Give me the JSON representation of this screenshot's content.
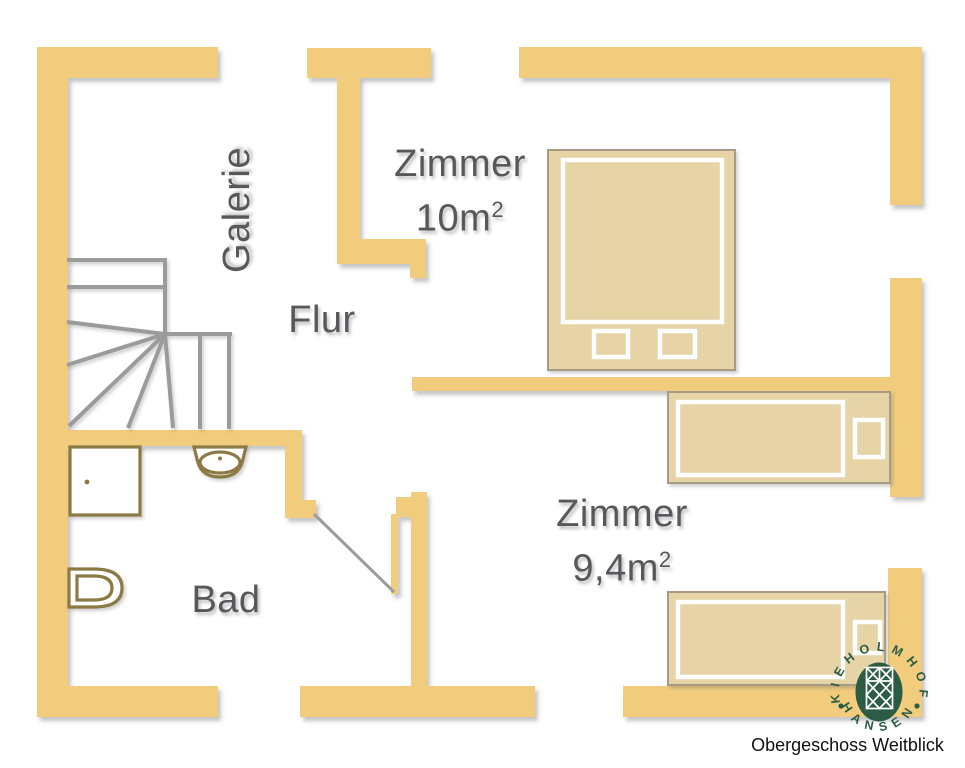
{
  "plan": {
    "colors": {
      "wall": "#F0CC7C",
      "stairs": "#9B9B9B",
      "fixture": "#8C7A45",
      "bed_fill": "#E6D3A6",
      "bed_border": "#A79B85",
      "label": "#58585A",
      "logo_green": "#2D5C45",
      "caption": "#111111"
    },
    "rooms": {
      "galerie": {
        "label": "Galerie"
      },
      "zimmer_10": {
        "label": "Zimmer",
        "area": "10m",
        "area_sup": "2"
      },
      "flur": {
        "label": "Flur"
      },
      "zimmer_9_4": {
        "label": "Zimmer",
        "area": "9,4m",
        "area_sup": "2"
      },
      "bad": {
        "label": "Bad"
      }
    }
  },
  "logo": {
    "arc_top": "KIEHOLMHOF",
    "arc_bottom": "HANSEN"
  },
  "caption": "Obergeschoss Weitblick"
}
